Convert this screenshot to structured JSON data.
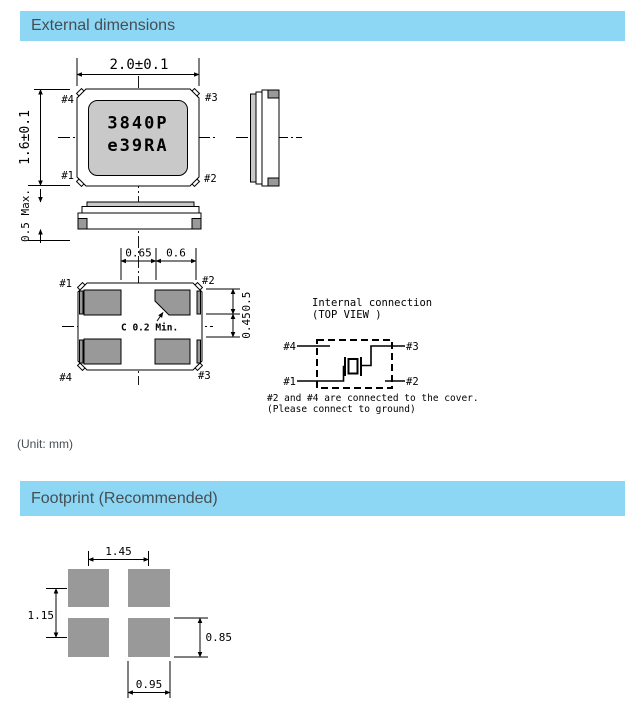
{
  "headers": {
    "external": "External dimensions",
    "footprint": "Footprint (Recommended)"
  },
  "unit_note": "(Unit: mm)",
  "external_drawing": {
    "top_view": {
      "marking_line1": "3840P",
      "marking_line2": "e39RA",
      "dim_width": "2.0±0.1",
      "dim_height": "1.6±0.1",
      "pins": {
        "top_left": "#4",
        "top_right": "#3",
        "bottom_left": "#1",
        "bottom_right": "#2"
      }
    },
    "side_view": {
      "dim_thickness": "0.5 Max."
    },
    "bottom_view": {
      "dim_gap": "0.65",
      "dim_pad_width": "0.6",
      "dim_pad_height": "0.5",
      "dim_row_gap": "0.45",
      "chamfer_note": "C 0.2 Min.",
      "pins": {
        "top_left": "#1",
        "top_right": "#2",
        "bottom_left": "#4",
        "bottom_right": "#3"
      }
    },
    "internal_connection": {
      "title": "Internal connection",
      "subtitle": "(TOP VIEW )",
      "pins": {
        "top_left": "#4",
        "top_right": "#3",
        "bottom_left": "#1",
        "bottom_right": "#2"
      },
      "note_line1": "#2 and #4 are connected to the cover.",
      "note_line2": "(Please connect to ground)"
    }
  },
  "footprint_drawing": {
    "dim_pitch_x": "1.45",
    "dim_pitch_y": "1.15",
    "dim_pad_height": "0.85",
    "dim_pad_width": "0.95"
  },
  "colors": {
    "header_bg": "#8dd7f5",
    "header_text": "#454e54",
    "pad_gray": "#999999",
    "marking_gray": "#c9c9c9",
    "line": "#000000"
  }
}
